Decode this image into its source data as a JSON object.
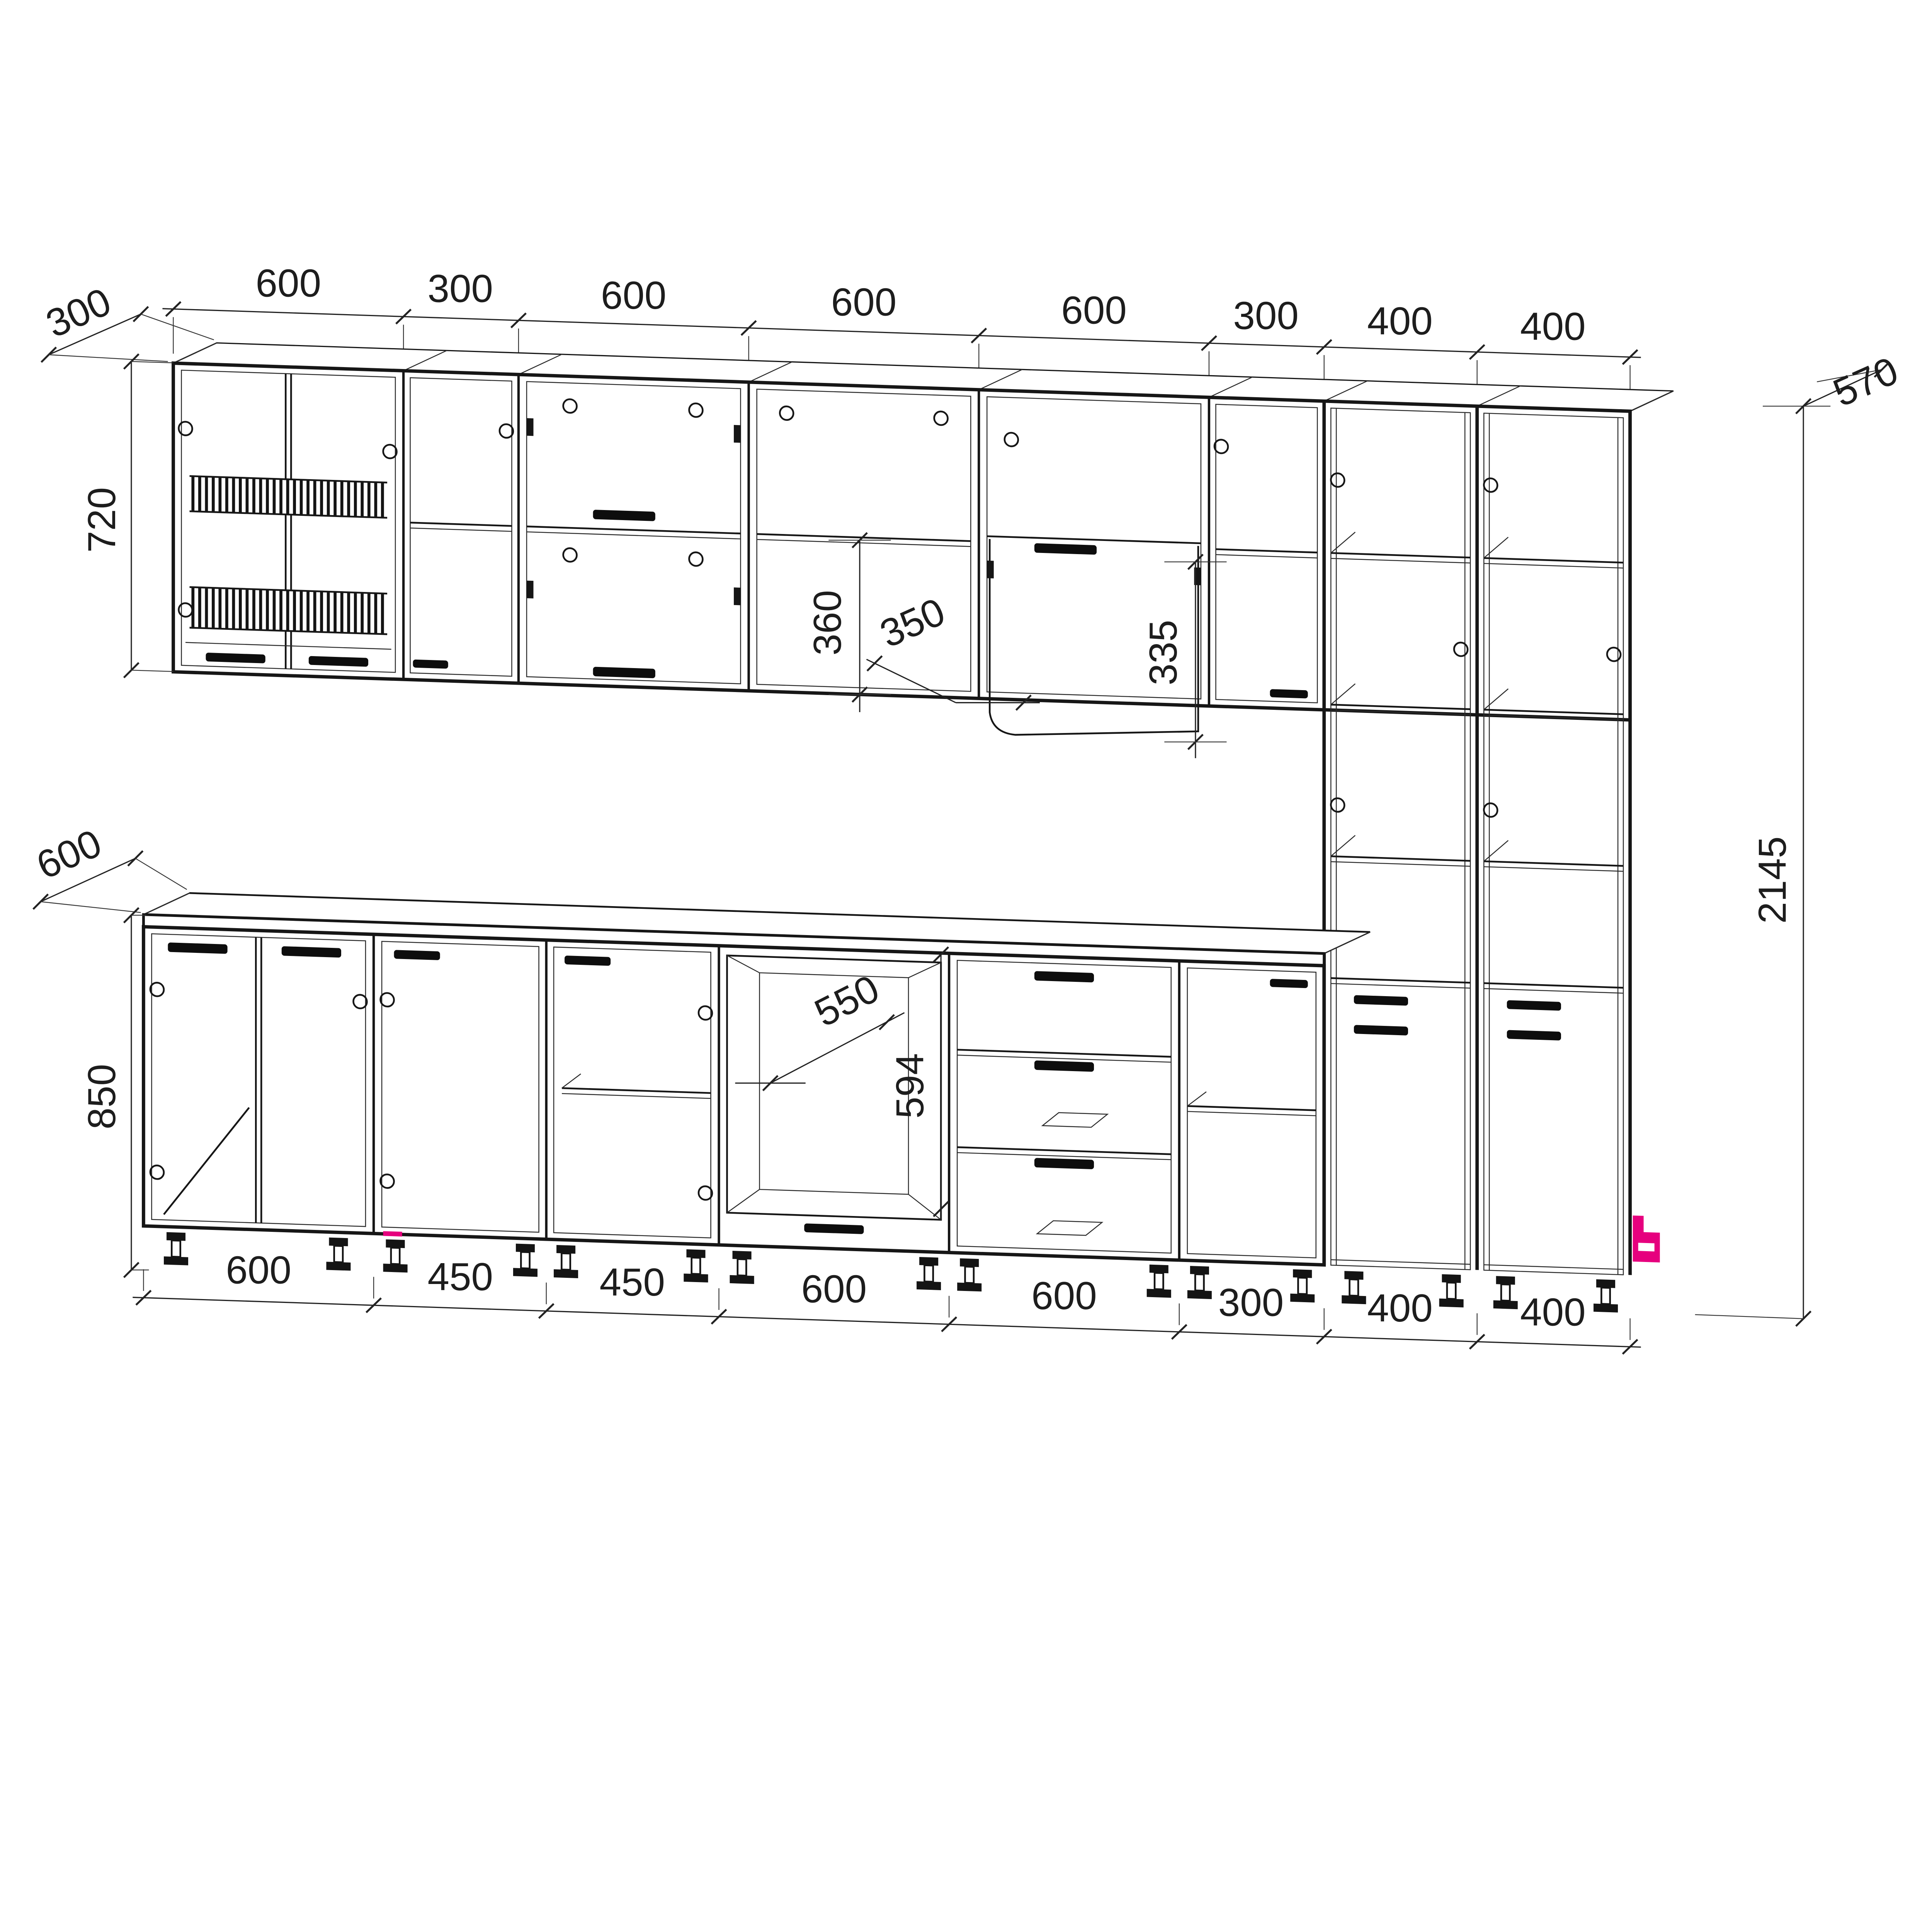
{
  "drawing": {
    "kind": "kitchen-cabinet-set-dimensioned-wireframe",
    "units": "mm",
    "line_color": "#161616",
    "accent_color": "#e6007e",
    "dims": {
      "top_chain": [
        "600",
        "300",
        "600",
        "600",
        "600",
        "300",
        "400",
        "400"
      ],
      "bottom_chain": [
        "600",
        "450",
        "450",
        "600",
        "600",
        "300",
        "400",
        "400"
      ],
      "wall_depth": "300",
      "wall_height": "720",
      "base_depth": "600",
      "base_height": "850",
      "tall_depth": "570",
      "tall_height": "2145",
      "wall_open_lower": "360",
      "wall_clearance": "350",
      "wall_flip_door": "335",
      "oven_niche_depth": "550",
      "oven_niche_height": "594"
    },
    "components": {
      "wall_row": [
        "wall-cabinet-dish-rack-600",
        "wall-cabinet-300",
        "wall-cabinet-two-flip-doors-600",
        "wall-cabinet-open-shelf-600",
        "wall-cabinet-flip-door-600",
        "wall-cabinet-300"
      ],
      "tall_units": [
        "tall-cabinet-400",
        "tall-cabinet-400"
      ],
      "base_row": [
        "sink-base-two-doors-600",
        "base-door-450",
        "base-door-shelf-450",
        "oven-housing-600",
        "drawer-base-three-drawers-600",
        "base-open-shelf-300"
      ],
      "accents": [
        "pink-marker-plinth",
        "pink-marker-tall-corner"
      ]
    }
  }
}
